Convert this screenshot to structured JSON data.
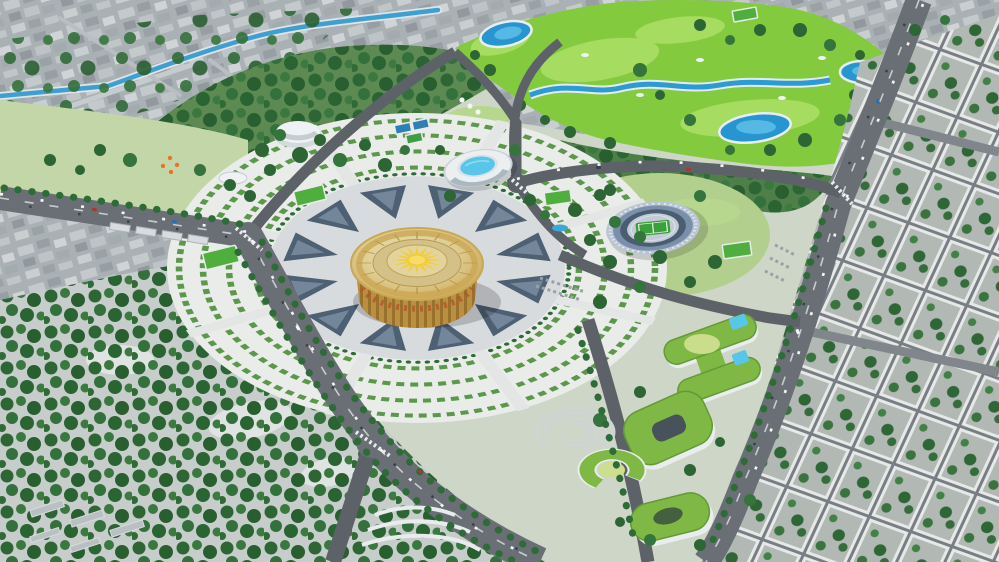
{
  "scene": {
    "type": "3d-aerial-architectural-rendering",
    "description": "Bird's-eye 3D visualization of an urban master plan: a golden circular ceremonial hall with a sunburst roof sits at the center of a radial paved plaza ringed by dark triangular ornament motifs and fan-shaped parterre hedge gardens. Around it: an oval stadium with athletics track, an elliptical aquatic arena with rooftop pool, a white dome pavilion, a bright golf course with lakes and a winding river, green-roofed civic buildings with rooftop pools, tree-lined boulevards with traffic, dense forest parkland, an old-town quarter crossed by a canal, and surrounding city street grids.",
    "landmarks": [
      {
        "id": "golden-rotunda",
        "label": "Golden circular hall with sunburst roof"
      },
      {
        "id": "ceremonial-plaza",
        "label": "Radial plaza with triangular paving motifs"
      },
      {
        "id": "parterre-gardens",
        "label": "Fan-shaped hedge garden rings"
      },
      {
        "id": "stadium",
        "label": "Oval stadium with track and pitch"
      },
      {
        "id": "aquatic-center",
        "label": "Elliptical aquatic arena with roof pool"
      },
      {
        "id": "dome-pavilion",
        "label": "White dome pavilion"
      },
      {
        "id": "golf-course",
        "label": "Golf course with lakes and river"
      },
      {
        "id": "green-roof-campus",
        "label": "Green-roofed buildings with pools"
      },
      {
        "id": "amphitheater-park",
        "label": "Spiral amphitheater park"
      },
      {
        "id": "forest-park",
        "label": "Dense forest parkland"
      },
      {
        "id": "old-town",
        "label": "Old town quarter with canal"
      },
      {
        "id": "city-grid",
        "label": "City street-grid blocks"
      },
      {
        "id": "sports-fields",
        "label": "Green and blue sports courts"
      },
      {
        "id": "boulevards",
        "label": "Tree-lined boulevards with traffic"
      }
    ],
    "palette": {
      "city_ground": "#aab1b5",
      "park_ground": "#cdd6c7",
      "forest_green": "#2d6634",
      "golf_green": "#84ca3e",
      "fairway": "#a6dc60",
      "water": "#2d9bd3",
      "road_major": "#6a6f76",
      "road_minor": "#5d6269",
      "plaza": "#d8dbde",
      "plaza_motif": "#4e6073",
      "garden_ground": "#e9ece9",
      "hedge_green": "#5c974b",
      "rotunda_gold": "#c9a855",
      "sun_yellow": "#f2cd3a",
      "stadium_shell": "#b9c5d3",
      "stadium_stands": "#7a90aa",
      "pitch_green": "#3aa03c",
      "green_roof": "#7fb845",
      "building_white": "#eceff0",
      "pool_blue": "#58c6e8"
    }
  }
}
